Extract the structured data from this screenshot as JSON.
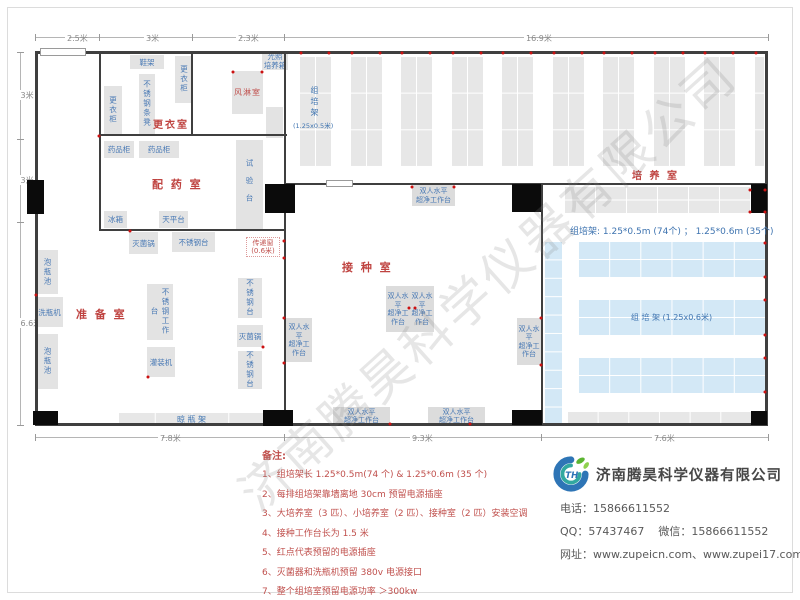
{
  "watermark": "济南腾昊科学仪器有限公司",
  "colors": {
    "wall": "#3f3f3f",
    "furniture_fill": "#e3e3e3",
    "furniture_text": "#4a7ab5",
    "room_label": "#bf4340",
    "rack_gray": "#e7e7e7",
    "rack_blue": "#d3e8f6",
    "outlet_dot": "#cc1111",
    "dimension_text": "#8a8a8a",
    "notes_text": "#c0504d",
    "company_text": "#595959",
    "logo_blue": "#2e75b6",
    "logo_green": "#5bb531"
  },
  "plan": {
    "walls": [
      [
        35,
        51,
        733,
        3
      ],
      [
        35,
        423,
        733,
        3
      ],
      [
        35,
        51,
        3,
        375
      ],
      [
        765,
        51,
        3,
        375
      ],
      [
        99,
        51,
        2,
        180
      ],
      [
        99,
        229,
        187,
        2
      ],
      [
        191,
        51,
        2,
        85
      ],
      [
        99,
        134,
        188,
        2
      ],
      [
        284,
        51,
        2,
        374
      ],
      [
        284,
        183,
        484,
        2
      ],
      [
        541,
        183,
        2,
        242
      ]
    ],
    "windows": [
      [
        40,
        48,
        46,
        8
      ],
      [
        326,
        180,
        27,
        7
      ]
    ],
    "doors": [
      [
        27,
        180,
        17,
        34
      ],
      [
        33,
        411,
        25,
        14
      ],
      [
        265,
        184,
        30,
        29
      ],
      [
        263,
        410,
        30,
        16
      ],
      [
        512,
        184,
        29,
        28
      ],
      [
        512,
        410,
        30,
        15
      ],
      [
        751,
        184,
        16,
        29
      ],
      [
        751,
        411,
        16,
        14
      ]
    ],
    "furniture": [
      {
        "name": "shoe-rack",
        "label": "鞋架",
        "x": 130,
        "y": 55,
        "w": 34,
        "h": 14
      },
      {
        "name": "wardrobe-right",
        "label": "更衣柜",
        "x": 175,
        "y": 56,
        "w": 18,
        "h": 47,
        "dir": "v"
      },
      {
        "name": "stainless-bench",
        "label": "不锈钢条凳",
        "x": 139,
        "y": 74,
        "w": 16,
        "h": 60,
        "dir": "v"
      },
      {
        "name": "wardrobe-left",
        "label": "更衣柜",
        "x": 104,
        "y": 86,
        "w": 18,
        "h": 49,
        "dir": "v"
      },
      {
        "name": "air-shower-room",
        "label": "风淋室",
        "x": 232,
        "y": 71,
        "w": 31,
        "h": 43,
        "red": true
      },
      {
        "name": "light-incubator",
        "label": "光照\n培养箱",
        "x": 262,
        "y": 52,
        "w": 26,
        "h": 18
      },
      {
        "name": "small-cabinet",
        "label": "",
        "x": 266,
        "y": 107,
        "w": 17,
        "h": 31
      },
      {
        "name": "medicine-cabinet-1",
        "label": "药品柜",
        "x": 104,
        "y": 141,
        "w": 30,
        "h": 17
      },
      {
        "name": "medicine-cabinet-2",
        "label": "药品柜",
        "x": 139,
        "y": 141,
        "w": 40,
        "h": 17
      },
      {
        "name": "test-bench",
        "label": "试验台",
        "x": 236,
        "y": 140,
        "w": 27,
        "h": 91,
        "dir": "v",
        "sp": true
      },
      {
        "name": "fridge",
        "label": "冰箱",
        "x": 104,
        "y": 211,
        "w": 23,
        "h": 17
      },
      {
        "name": "balance-table",
        "label": "天平台",
        "x": 159,
        "y": 211,
        "w": 29,
        "h": 17
      },
      {
        "name": "sterilizer-top",
        "label": "灭菌锅",
        "x": 129,
        "y": 232,
        "w": 29,
        "h": 22
      },
      {
        "name": "stainless-table-top",
        "label": "不锈钢台",
        "x": 172,
        "y": 232,
        "w": 43,
        "h": 20
      },
      {
        "name": "soaking-pool-1",
        "label": "泡瓶池",
        "x": 37,
        "y": 250,
        "w": 21,
        "h": 44,
        "dir": "v"
      },
      {
        "name": "bottle-washer",
        "label": "洗瓶机",
        "x": 36,
        "y": 297,
        "w": 27,
        "h": 30
      },
      {
        "name": "soaking-pool-2",
        "label": "泡瓶池",
        "x": 37,
        "y": 334,
        "w": 21,
        "h": 55,
        "dir": "v"
      },
      {
        "name": "stainless-worktable",
        "label": "不锈钢工作台",
        "x": 147,
        "y": 284,
        "w": 26,
        "h": 56,
        "dir": "v"
      },
      {
        "name": "filling-machine",
        "label": "灌装机",
        "x": 147,
        "y": 347,
        "w": 28,
        "h": 30
      },
      {
        "name": "stainless-table-r1",
        "label": "不锈钢台",
        "x": 238,
        "y": 278,
        "w": 24,
        "h": 40,
        "dir": "v"
      },
      {
        "name": "sterilizer-right",
        "label": "灭菌锅",
        "x": 237,
        "y": 325,
        "w": 26,
        "h": 22
      },
      {
        "name": "stainless-table-r2",
        "label": "不锈钢台",
        "x": 238,
        "y": 351,
        "w": 24,
        "h": 38,
        "dir": "v"
      }
    ],
    "bench_label": "双人水平\n超净工作台",
    "benches": [
      {
        "x": 412,
        "y": 185,
        "w": 43,
        "h": 21
      },
      {
        "x": 386,
        "y": 286,
        "w": 24,
        "h": 46
      },
      {
        "x": 410,
        "y": 286,
        "w": 24,
        "h": 46
      },
      {
        "x": 286,
        "y": 318,
        "w": 26,
        "h": 44
      },
      {
        "x": 517,
        "y": 318,
        "w": 24,
        "h": 47
      },
      {
        "x": 333,
        "y": 407,
        "w": 57,
        "h": 18
      },
      {
        "x": 428,
        "y": 407,
        "w": 57,
        "h": 18
      }
    ],
    "gray_columns": {
      "x0": 299,
      "pitch": 50.5,
      "count": 10,
      "y": 56,
      "h": 110,
      "w": 32,
      "rows": 3,
      "cols": 2,
      "clip": 764
    },
    "racks": [
      {
        "name": "rack-top-right-gray",
        "type": "gray",
        "x": 564,
        "y": 186,
        "w": 186,
        "h": 27,
        "rows": 2,
        "cols": 6
      },
      {
        "name": "rack-blue-vertical",
        "type": "blue",
        "x": 544,
        "y": 241,
        "w": 18,
        "h": 184,
        "rows": 10,
        "cols": 1
      },
      {
        "name": "rack-blue-1",
        "type": "blue",
        "x": 578,
        "y": 241,
        "w": 187,
        "h": 36,
        "rows": 2,
        "cols": 6
      },
      {
        "name": "rack-blue-2",
        "type": "blue",
        "x": 578,
        "y": 299,
        "w": 187,
        "h": 36,
        "rows": 2,
        "cols": 6,
        "label": "组 培 架 (1.25x0.6米)"
      },
      {
        "name": "rack-blue-3",
        "type": "blue",
        "x": 578,
        "y": 357,
        "w": 187,
        "h": 36,
        "rows": 2,
        "cols": 6
      },
      {
        "name": "rack-bottom-gray",
        "type": "gray",
        "x": 567,
        "y": 411,
        "w": 184,
        "h": 13,
        "rows": 1,
        "cols": 6
      },
      {
        "name": "bottle-drying-rack",
        "type": "gray",
        "x": 118,
        "y": 412,
        "w": 147,
        "h": 14,
        "rows": 1,
        "cols": 4,
        "label": "晾  瓶  架"
      }
    ],
    "rack_column_label": {
      "chars": "组培架",
      "size": "(1.25x0.5米)",
      "x": 306,
      "y": 86,
      "x2": 293,
      "y2": 120
    },
    "culture_info": {
      "text": "组培架: 1.25*0.5m (74个) ； 1.25*0.6m (35个)",
      "x": 570,
      "y": 224,
      "w": 200
    },
    "transfer_window": {
      "text": "传递窗\n(0.6米)",
      "x": 246,
      "y": 237
    },
    "room_labels": [
      {
        "name": "room-dressing",
        "label": "更衣室",
        "x": 153,
        "y": 116,
        "size": 10
      },
      {
        "name": "room-pharmacy",
        "label": "配 药 室",
        "x": 152,
        "y": 176,
        "size": 11
      },
      {
        "name": "room-preparation",
        "label": "准 备 室",
        "x": 76,
        "y": 306,
        "size": 11
      },
      {
        "name": "room-inoculation",
        "label": "接 种 室",
        "x": 342,
        "y": 259,
        "size": 11
      },
      {
        "name": "room-culture",
        "label": "培 养 室",
        "x": 632,
        "y": 167,
        "size": 10
      }
    ],
    "dimensions": [
      {
        "axis": "h",
        "pos": 37,
        "from": 35,
        "to": 768,
        "ticks": [
          35,
          99,
          192,
          284,
          768
        ],
        "labels": [
          {
            "t": "2.5米",
            "c": 67
          },
          {
            "t": "3米",
            "c": 146
          },
          {
            "t": "2.3米",
            "c": 238
          },
          {
            "t": "16.9米",
            "c": 526
          }
        ]
      },
      {
        "axis": "v",
        "pos": 20,
        "from": 52,
        "to": 425,
        "ticks": [
          52,
          139,
          222,
          425
        ],
        "labels": [
          {
            "t": "3米",
            "c": 95
          },
          {
            "t": "3米",
            "c": 180
          },
          {
            "t": "6.6米",
            "c": 323
          }
        ]
      },
      {
        "axis": "h",
        "pos": 437,
        "from": 35,
        "to": 768,
        "ticks": [
          35,
          284,
          541,
          768
        ],
        "labels": [
          {
            "t": "7.8米",
            "c": 160
          },
          {
            "t": "9.3米",
            "c": 412
          },
          {
            "t": "7.6米",
            "c": 654
          }
        ]
      }
    ],
    "outlets": [
      [
        284,
        241
      ],
      [
        284,
        258
      ],
      [
        233,
        72
      ],
      [
        262,
        72
      ],
      [
        99,
        136
      ],
      [
        36,
        295
      ],
      [
        130,
        231
      ],
      [
        148,
        377
      ],
      [
        263,
        347
      ],
      [
        284,
        318
      ],
      [
        284,
        363
      ],
      [
        541,
        318
      ],
      [
        541,
        365
      ],
      [
        412,
        187
      ],
      [
        454,
        187
      ],
      [
        409,
        308
      ],
      [
        415,
        308
      ],
      [
        390,
        424
      ],
      [
        470,
        424
      ],
      [
        750,
        190
      ],
      [
        750,
        212
      ],
      [
        765,
        190
      ],
      [
        765,
        212
      ],
      [
        765,
        243
      ],
      [
        765,
        277
      ],
      [
        765,
        300
      ],
      [
        765,
        335
      ],
      [
        765,
        358
      ],
      [
        765,
        392
      ]
    ]
  },
  "notes": {
    "title": "备注:",
    "items": [
      "1、组培架长 1.25*0.5m(74 个) & 1.25*0.6m (35 个)",
      "2、每排组培架靠墙离地 30cm 预留电源插座",
      "3、大培养室（3 匹）、小培养室（2 匹）、接种室（2 匹）安装空调",
      "4、接种工作台长为 1.5 米",
      "5、红点代表预留的电源插座",
      "6、灭菌器和洗瓶机预留 380v 电源接口",
      "7、整个组培室预留电源功率 ＞300kw",
      "8、培养室推拉门地轨和地面一平，方便小推车推送。"
    ]
  },
  "company": {
    "name": "济南腾昊科学仪器有限公司",
    "phone_label": "电话：",
    "phone": "15866611552",
    "qq_label": "QQ：",
    "qq": "57437467",
    "wechat_label": "微信：",
    "wechat": "15866611552",
    "web_label": "网址：",
    "web": "www.zupeicn.com、www.zupei17.com"
  }
}
